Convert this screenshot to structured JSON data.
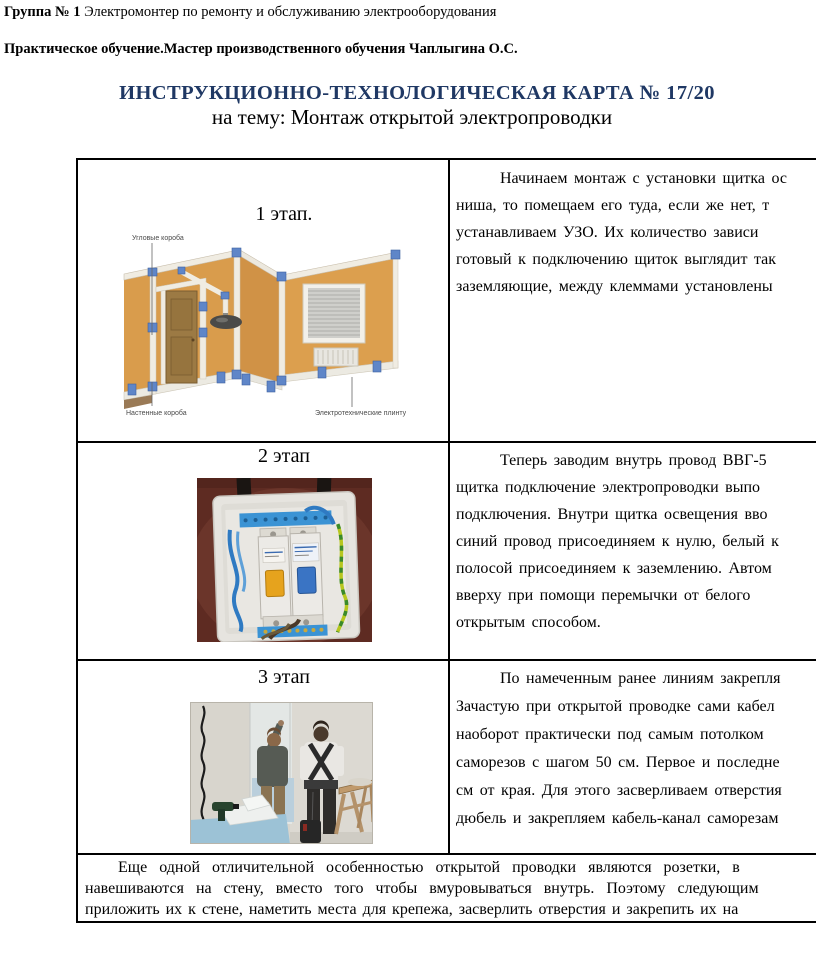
{
  "header": {
    "group_label": "Группа № 1",
    "group_text": " Электромонтер по ремонту и обслуживанию электрооборудования",
    "training_line": "Практическое обучение.Мастер производственного обучения Чаплыгина О.С.",
    "title": "ИНСТРУКЦИОННО-ТЕХНОЛОГИЧЕСКАЯ КАРТА № 17/20",
    "subtitle": "на тему: Монтаж открытой электропроводки",
    "title_color": "#1f3864"
  },
  "table": {
    "rows": [
      {
        "stage_label": "1 этап.",
        "image_name": "room-open-wiring-diagram",
        "image_labels": {
          "corner_ducts": "Угловые короба",
          "wall_ducts": "Настенные короба",
          "plinths": "Электротехнические плинтусы"
        },
        "lines": [
          "Начинаем монтаж с установки щитка ос",
          "ниша, то помещаем его туда, если же нет, т",
          "устанавливаем УЗО. Их количество зависи",
          "готовый к подключению щиток выглядит так",
          "заземляющие, между клеммами установлены"
        ]
      },
      {
        "stage_label": "2 этап",
        "image_name": "distribution-board-photo",
        "lines": [
          "Теперь заводим внутрь провод ВВГ-5",
          "щитка подключение электропроводки выпо",
          "подключения. Внутри щитка освещения вво",
          "синий провод присоединяем к нулю, белый к",
          "полосой присоединяем к заземлению. Автом",
          "вверху при помощи перемычки от белого",
          "открытым способом."
        ]
      },
      {
        "stage_label": "3 этап",
        "image_name": "workers-marking-wall-photo",
        "lines": [
          "По намеченным ранее линиям закрепля",
          "Зачастую при открытой проводке сами кабел",
          "наоборот практически под самым потолком",
          "саморезов с шагом 50 см. Первое и последне",
          "см от края. Для этого засверливаем отверстия",
          "дюбель и закрепляем кабель-канал саморезам"
        ]
      }
    ],
    "footer_lines": [
      "Еще одной отличительной особенностью открытой проводки являются розетки, в",
      "навешиваются на стену, вместо того чтобы вмуровываться внутрь. Поэтому следующим",
      "приложить их к стене, наметить места для крепежа, засверлить отверстия и закрепить их на"
    ]
  }
}
